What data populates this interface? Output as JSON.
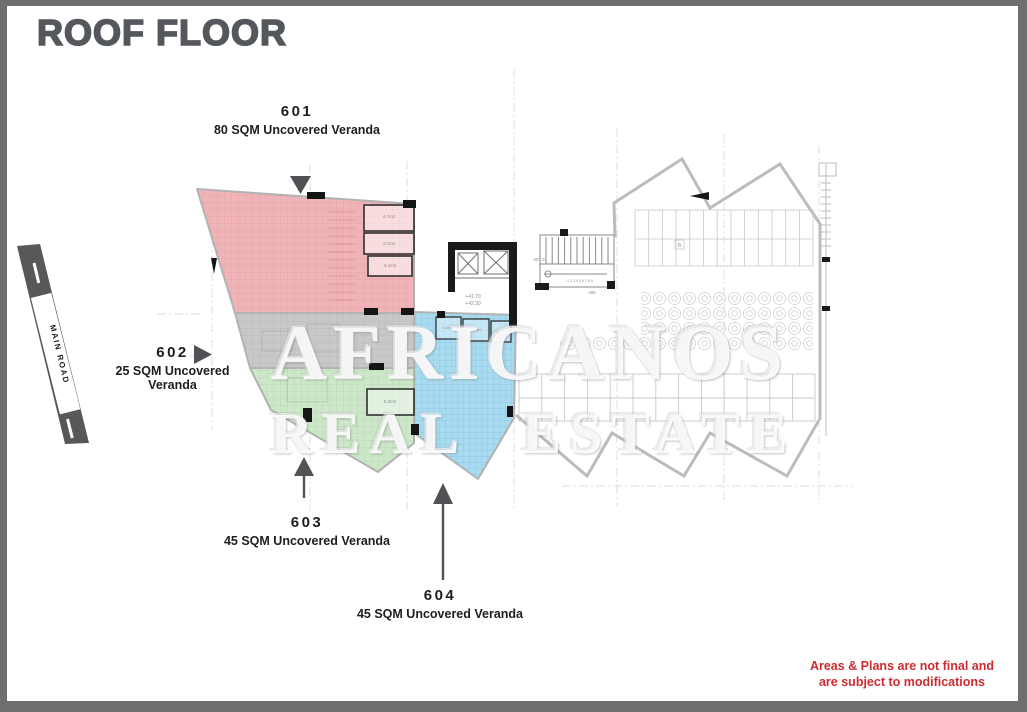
{
  "title": {
    "text": "ROOF FLOOR",
    "color": "#54585c"
  },
  "units": [
    {
      "number": "601",
      "description": "80 SQM Uncovered Veranda",
      "color": "#efb4b8",
      "arrow_direction": "down"
    },
    {
      "number": "602",
      "description": "25 SQM Uncovered Veranda",
      "color": "#c9c8c8",
      "arrow_direction": "right"
    },
    {
      "number": "603",
      "description": "45 SQM Uncovered Veranda",
      "color": "#cde7c9",
      "arrow_direction": "up"
    },
    {
      "number": "604",
      "description": "45 SQM Uncovered Veranda",
      "color": "#a8dbf0",
      "arrow_direction": "up"
    }
  ],
  "road": {
    "label": "MAIN ROAD",
    "color": "#57585a"
  },
  "watermark": {
    "line1": "AFRICANOS",
    "line2": "REAL ESTATE"
  },
  "disclaimer": {
    "line1": "Areas & Plans are not final and",
    "line2": "are subject to modifications",
    "color": "#ce2b31"
  },
  "colors": {
    "arrow": "#515256",
    "outline": "#bcbcbc",
    "core_wall": "#1a1a1a"
  },
  "plan": {
    "annotations": [
      {
        "text": "4.7m2"
      },
      {
        "text": "4.7m2"
      },
      {
        "text": "3.4m2"
      },
      {
        "text": "6.4m2"
      },
      {
        "text": "3.6m2"
      },
      {
        "text": "3.9m2"
      },
      {
        "text": "5.0m2"
      },
      {
        "text": "+41.70"
      },
      {
        "text": "+42.30"
      },
      {
        "text": "307.9"
      },
      {
        "text": "485"
      },
      {
        "text": "1 2 3 4 5 6 7 8 9"
      },
      {
        "text": "B"
      }
    ]
  }
}
